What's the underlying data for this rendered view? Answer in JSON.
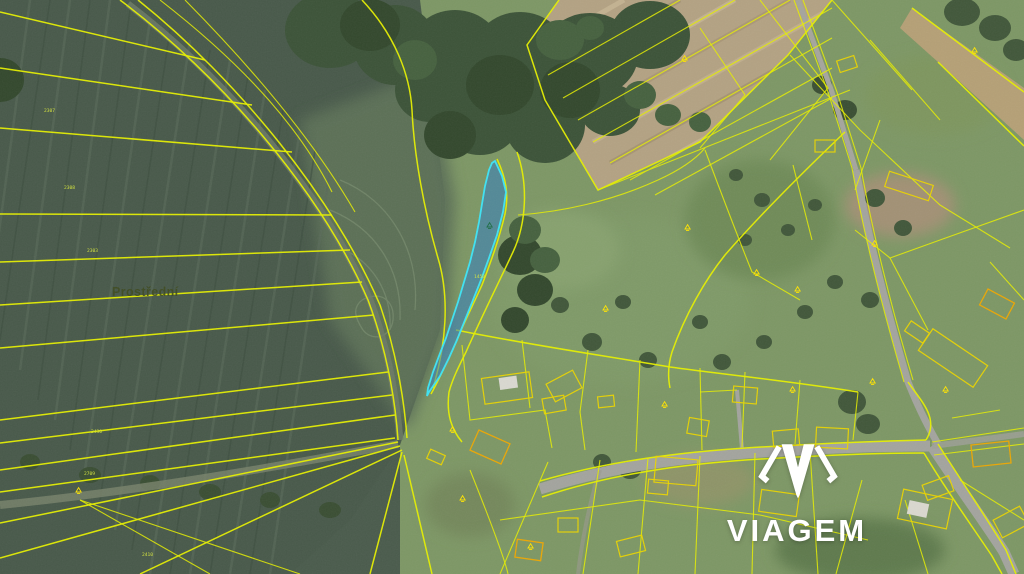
{
  "map": {
    "region_label": "Prostřední",
    "line_color": "#e6ef00",
    "highlight": {
      "fill": "#2d7dc6",
      "fill_opacity": 0.52,
      "stroke": "#3fe2f2",
      "stroke_width": 1.8
    },
    "parcel_numbers": [
      {
        "text": "2307",
        "x": 44,
        "y": 112
      },
      {
        "text": "2308",
        "x": 64,
        "y": 189
      },
      {
        "text": "2303",
        "x": 87,
        "y": 252
      },
      {
        "text": "2430",
        "x": 91,
        "y": 433
      },
      {
        "text": "2709",
        "x": 84,
        "y": 475
      },
      {
        "text": "2410",
        "x": 142,
        "y": 556
      },
      {
        "text": "1450",
        "x": 474,
        "y": 278
      }
    ],
    "markers": [
      {
        "x": 487,
        "y": 227,
        "color": "#1e6e46"
      },
      {
        "x": 76,
        "y": 492,
        "color": "#ffe400"
      },
      {
        "x": 682,
        "y": 60,
        "color": "#ffe400"
      },
      {
        "x": 972,
        "y": 52,
        "color": "#ffe400"
      },
      {
        "x": 685,
        "y": 229,
        "color": "#ffe400"
      },
      {
        "x": 754,
        "y": 274,
        "color": "#ffe400"
      },
      {
        "x": 603,
        "y": 310,
        "color": "#ffe400"
      },
      {
        "x": 795,
        "y": 291,
        "color": "#ffe400"
      },
      {
        "x": 872,
        "y": 245,
        "color": "#ffe400"
      },
      {
        "x": 450,
        "y": 431,
        "color": "#ffe400"
      },
      {
        "x": 460,
        "y": 500,
        "color": "#ffe400"
      },
      {
        "x": 662,
        "y": 406,
        "color": "#ffe400"
      },
      {
        "x": 790,
        "y": 391,
        "color": "#ffe400"
      },
      {
        "x": 943,
        "y": 391,
        "color": "#ffe400"
      },
      {
        "x": 870,
        "y": 383,
        "color": "#ffe400"
      },
      {
        "x": 528,
        "y": 548,
        "color": "#ffe400"
      }
    ]
  },
  "watermark": {
    "brand": "VIAGEM",
    "icon": "viagem-diamond-icon",
    "color": "#ffffff"
  }
}
